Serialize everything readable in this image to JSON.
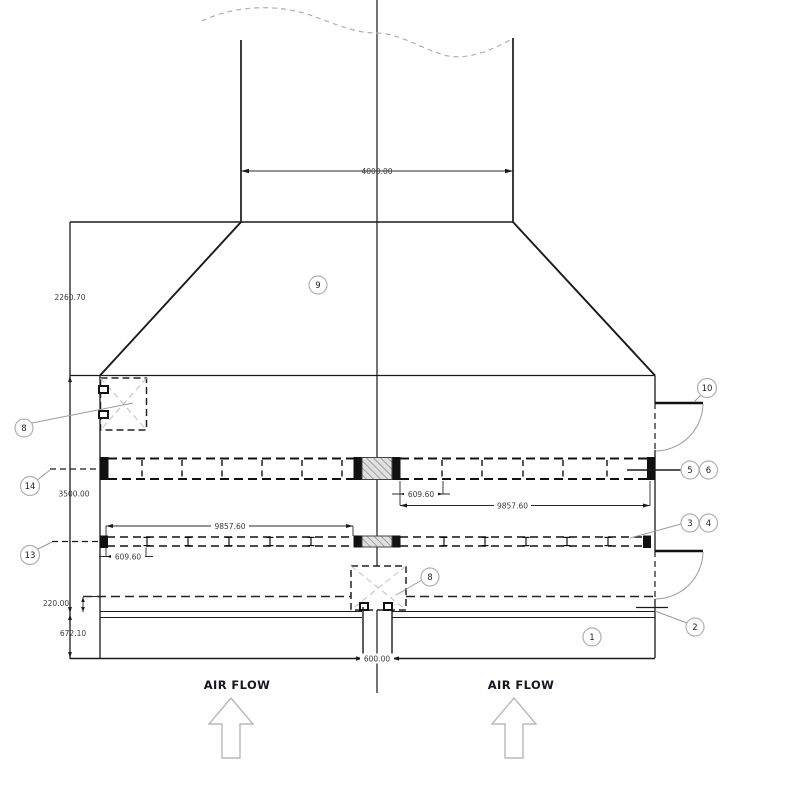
{
  "drawing": {
    "dimensions": {
      "duct_width": "4000.00",
      "hood_height": "2260.70",
      "casing_height": "3500.00",
      "water_level": "220.00",
      "basin_height": "672.10",
      "upper_header_offset": "609.60",
      "upper_header_length": "9857.60",
      "lower_header_length": "9857.60",
      "lower_header_offset": "609.60",
      "center_column_width": "600.00"
    },
    "callouts": {
      "c1": "1",
      "c2": "2",
      "c3": "3",
      "c4": "4",
      "c5": "5",
      "c6": "6",
      "c8_left": "8",
      "c8_center": "8",
      "c9": "9",
      "c10": "10",
      "c13": "13",
      "c14": "14"
    },
    "labels": {
      "air_flow_left": "AIR FLOW",
      "air_flow_right": "AIR FLOW"
    },
    "colors": {
      "line": "#1a1a1a",
      "dim_text": "#3a3a3a",
      "callout_stroke": "#b0b0b0",
      "leader": "#9a9a9a",
      "break_line": "#b0b0b0",
      "hatch_fill": "#e0e0e0",
      "hatch_stroke": "#777777",
      "arrow_outline": "#b8b8b8",
      "fill_black": "#111111"
    }
  }
}
